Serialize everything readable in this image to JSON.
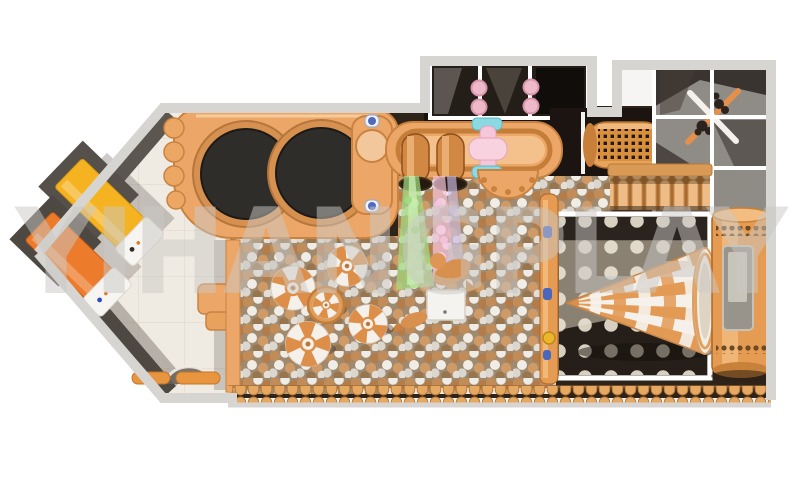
{
  "image": {
    "type": "3d-render-top-view",
    "subject": "indoor playground equipment layout plan"
  },
  "watermark": {
    "text": "YIHANGPLAY"
  },
  "palette": {
    "background": "#ffffff",
    "wall_outer": "#d7d5d2",
    "wall_dark": "#5c5650",
    "wall_dark2": "#4e4842",
    "floor_tile": "#f0ebe2",
    "tile_line": "#e2dbce",
    "hall_base": "#2e241a",
    "platform_orange": "#eca768",
    "platform_edge": "#c9823f",
    "platform_light": "#f4c18c",
    "trampoline_black": "#2f2d2a",
    "trampoline_ring": "#d6904f",
    "slide_yellow": "#f5b322",
    "slide_orange": "#ec7c2c",
    "mat_white": "#f7f5f1",
    "ball_bg": "#9f8a70",
    "ball_tan": "#c28c59",
    "ball_dark_tan": "#b47c49",
    "ball_white": "#efece6",
    "ball_gray": "#dbd7cf",
    "stream_green": "#a3dd82",
    "stream_pink": "#f2c0da",
    "stream_purple": "#cfc0e9",
    "structure_dark": "#17120e",
    "frame_white": "#ffffff",
    "post_pink": "#eebac9",
    "spinner_cyan": "#8bd9e2",
    "spinner_pink": "#f6c7d8",
    "mesh_orange": "#e9a45c",
    "mesh_hole": "#241708",
    "roller_orange": "#eebc86",
    "windmill_orange": "#e2904c",
    "windmill_white": "#f4f1ec",
    "dot_room_base": "#6e6458",
    "dot_room_dark": "#2b231d",
    "dot_room_light": "#9a9183",
    "dot_light": "#ebe3d2",
    "cone_orange": "#e29a55",
    "cone_white": "#f5f1ea",
    "tower_orange": "#e59b52",
    "tower_edge": "#a96526",
    "tower_slot": "#98948b",
    "log_orange": "#e7a962",
    "log_edge": "#b5793c",
    "hold_blue": "#4a67c0",
    "knob_gold": "#ecb62c",
    "watermark_gray": "#cbc9c6"
  },
  "elements": {
    "left_room": [
      "diagonal-entry-room",
      "yellow-toddler-slide",
      "orange-toddler-slide",
      "landing-mats",
      "arched-doorway-shadow",
      "entry-steps"
    ],
    "center": [
      "trampoline-platform",
      "round-trampolines",
      "ball-pit",
      "mushroom-spinners",
      "spinner-table",
      "ball-blower-box",
      "seal-figure",
      "ball-fountain-streams",
      "tube-slides",
      "pink-roller-spinner",
      "crawl-tunnel-mesh"
    ],
    "upper_level": [
      "white-frame-play-structure",
      "pink-punch-posts",
      "windmill-spinner",
      "roller-curtain"
    ],
    "right_room": [
      "polka-dot-room",
      "cone-carousel-slide",
      "slide-tower",
      "climbing-wall-holds"
    ],
    "border": [
      "log-fence-border",
      "outer-walls"
    ]
  }
}
